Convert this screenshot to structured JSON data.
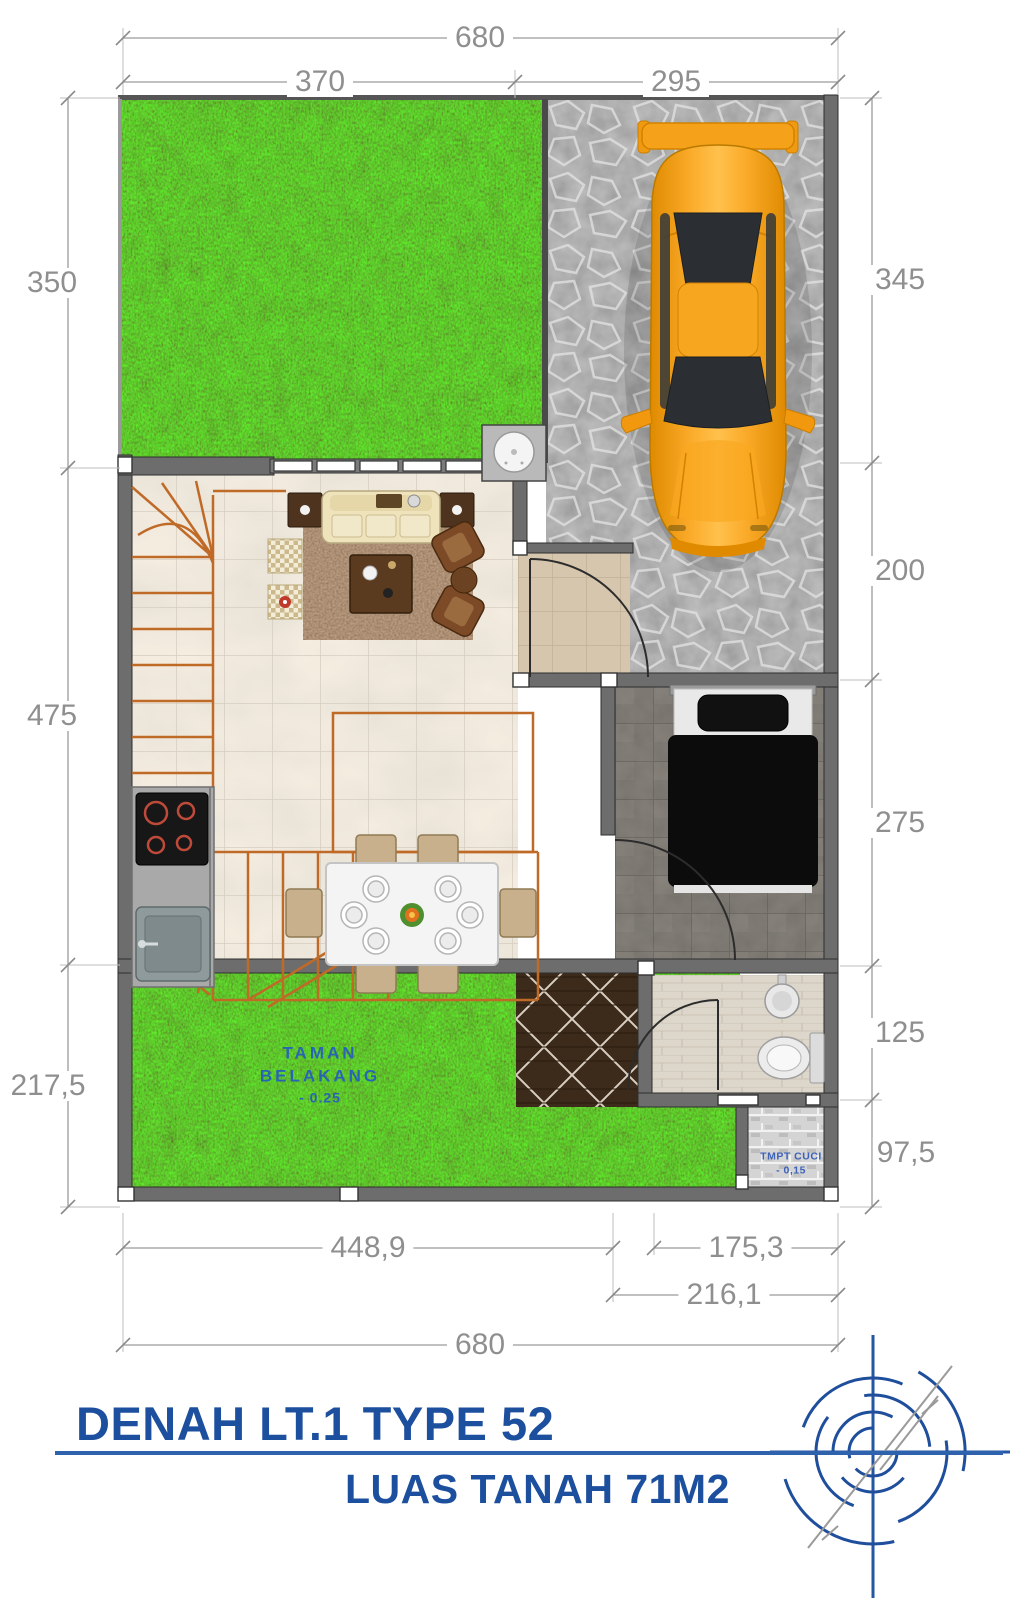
{
  "title_block": {
    "title": "DENAH LT.1 TYPE 52",
    "subtitle": "LUAS TANAH 71M2"
  },
  "dims": {
    "top_total": "680",
    "top_left": "370",
    "top_right": "295",
    "left_front_garden": "350",
    "left_living": "475",
    "left_back_garden": "217,5",
    "right_carport": "345",
    "right_entry": "200",
    "right_bedroom": "275",
    "right_bathroom": "125",
    "right_wash": "97,5",
    "bottom_left": "448,9",
    "bottom_right": "175,3",
    "bottom_mid": "216,1",
    "bottom_total": "680"
  },
  "rooms": {
    "back_garden": {
      "line1": "TAMAN",
      "line2": "BELAKANG",
      "line3": "- 0.25"
    },
    "wash": {
      "line1": "TMPT CUCI",
      "line2": "- 0,15"
    }
  },
  "icons": {
    "compass_logo": "architect-compass-logo"
  },
  "colors": {
    "accent_blue": "#1c4f9e",
    "label_blue": "#1e55cc",
    "dimension_gray": "#8f8f8f",
    "car_orange": "#f6a11a",
    "grass_green": "#3a7d14",
    "wall_gray": "#6d6d6d",
    "stone_gray": "#8e8e8e",
    "rule_blue": "#2e62ad"
  }
}
